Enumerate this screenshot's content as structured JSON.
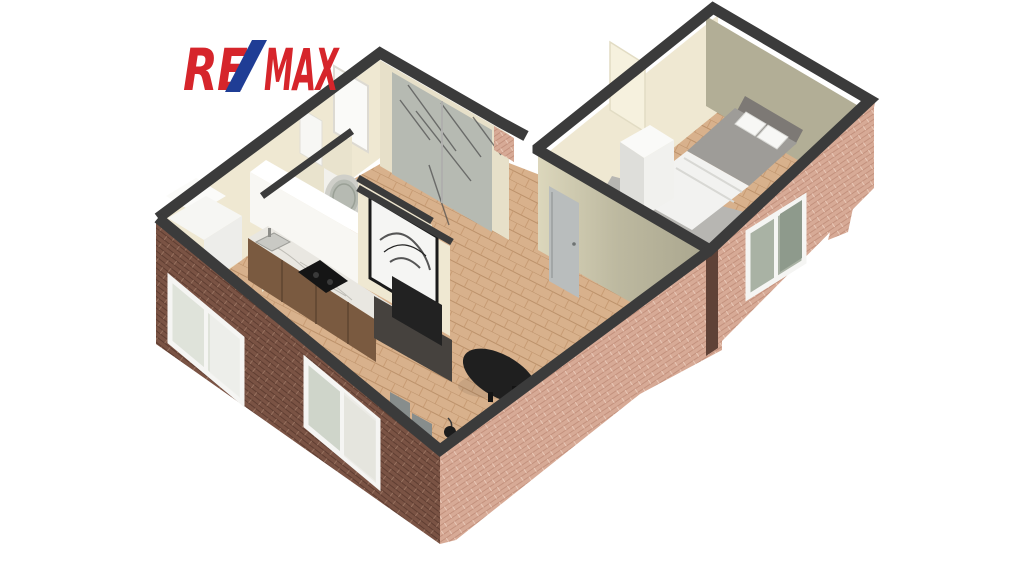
{
  "logo": {
    "re": "RE",
    "slash": "/",
    "max": "MAX",
    "color_red": "#D6252B",
    "color_blue": "#1F3D95"
  },
  "colors": {
    "background": "#ffffff",
    "wall_cap": "#3b3b3b",
    "wall_cream": "#EFE8D2",
    "wall_cream_dark": "#E7E0C9",
    "wall_olive": "#B2AE96",
    "brick_light_base": "#D7AA96",
    "brick_dark_base": "#7A5344",
    "floor_wood": "#D8B18C",
    "floor_wood_line": "#BB916A",
    "rug_grey": "#B7B6B2",
    "bed_duvet": "#9E9C98",
    "bed_sheet": "#F2F2F0",
    "furniture_dark": "#46423E",
    "tv_black": "#222222",
    "table_black": "#1F1F1F",
    "chair_grey": "#878D8C",
    "door_grey": "#B9BDBD",
    "glass_green": "#A9B2A4",
    "marble": "#E9E7E1",
    "wood_cabinet": "#7A5A40",
    "mirror_grey": "#B6BAB2"
  },
  "scene": {
    "type": "3d-floor-plan",
    "view": "isometric-dollhouse-render",
    "elements": [
      "bedroom",
      "living-room",
      "kitchen",
      "bathroom",
      "hallway",
      "utility-nook",
      "double-bed",
      "white-wardrobe",
      "kitchen-counter",
      "cooktop",
      "sink",
      "upper-cabinets",
      "tv-partition",
      "artwork",
      "tv-bench",
      "tv",
      "coffee-table",
      "chairs",
      "floor-lamp",
      "round-mirror",
      "mirrored-wardrobe",
      "entry-door",
      "bedroom-door",
      "brick-facade",
      "windows"
    ]
  }
}
